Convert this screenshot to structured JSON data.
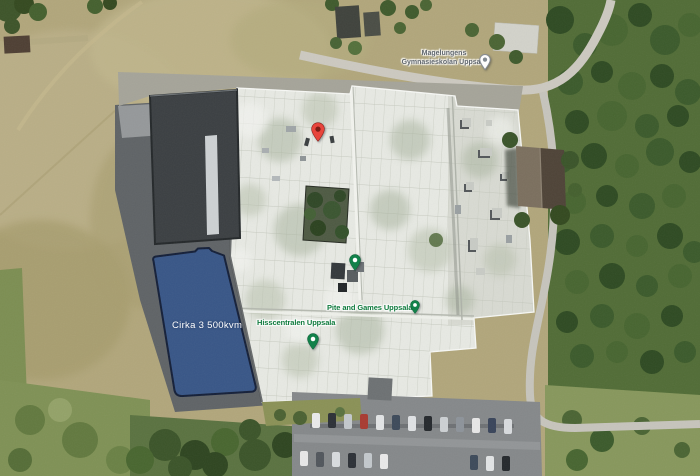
{
  "map": {
    "view": "satellite",
    "area_overlay": {
      "label": "Cirka 3 500kvm",
      "fill": "#33548c",
      "border": "#141f38"
    },
    "pois": [
      {
        "label": "Hisscentralen Uppsala",
        "marker": "green-pin"
      },
      {
        "label": "Pite and Games Uppsala",
        "marker": "green-pin"
      },
      {
        "label_line1": "Magelungens",
        "label_line2": "Gymnasieskolan Uppsala",
        "marker": "school-pin"
      }
    ],
    "markers": {
      "red_pin_color": "#e8453c",
      "red_pin_inner": "#7c1d15",
      "green_pin_color": "#12814a",
      "green_pin_inner": "#ffffff",
      "school_pin_color": "#fdfdfd",
      "school_pin_inner": "#828a92"
    }
  }
}
